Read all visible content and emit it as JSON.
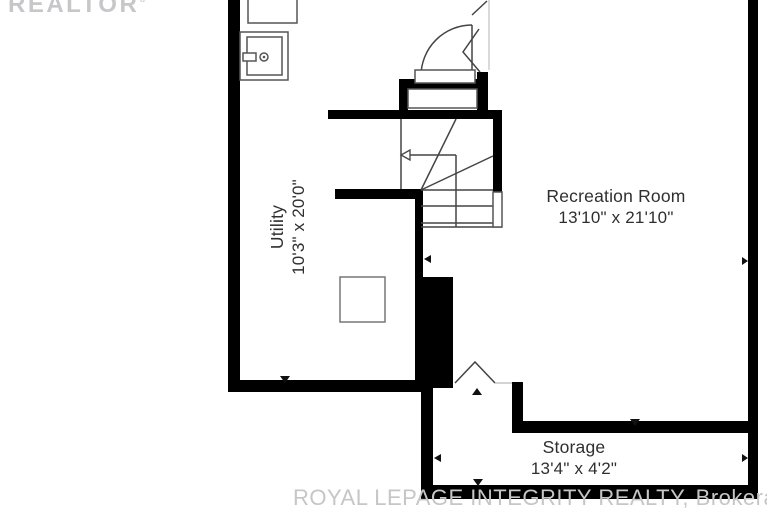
{
  "plan_title": "Basement floor plan",
  "watermarks": {
    "realtor": "REALTOR",
    "realtor_mark": "®",
    "brokerage": "ROYAL LEPAGE INTEGRITY REALTY,  Brokerage"
  },
  "rooms": [
    {
      "id": "utility",
      "name": "Utility",
      "dimensions": "10'3\" x 20'0\""
    },
    {
      "id": "recreation",
      "name": "Recreation Room",
      "dimensions": "13'10\" x 21'10\""
    },
    {
      "id": "storage",
      "name": "Storage",
      "dimensions": "13'4\" x 4'2\""
    }
  ],
  "fixtures": [
    "washer-icon",
    "laundry-sink-icon",
    "furnace-icon",
    "winder-staircase",
    "door-swing-icon",
    "bifold-door-icon",
    "stair-break-line",
    "dimension-arrows"
  ],
  "colors": {
    "wall": "#000000",
    "line": "#444444",
    "fixture": "#555555",
    "faint": "#c0c0c0",
    "label": "#2f2f2f",
    "watermark": "#c7c7ca"
  }
}
